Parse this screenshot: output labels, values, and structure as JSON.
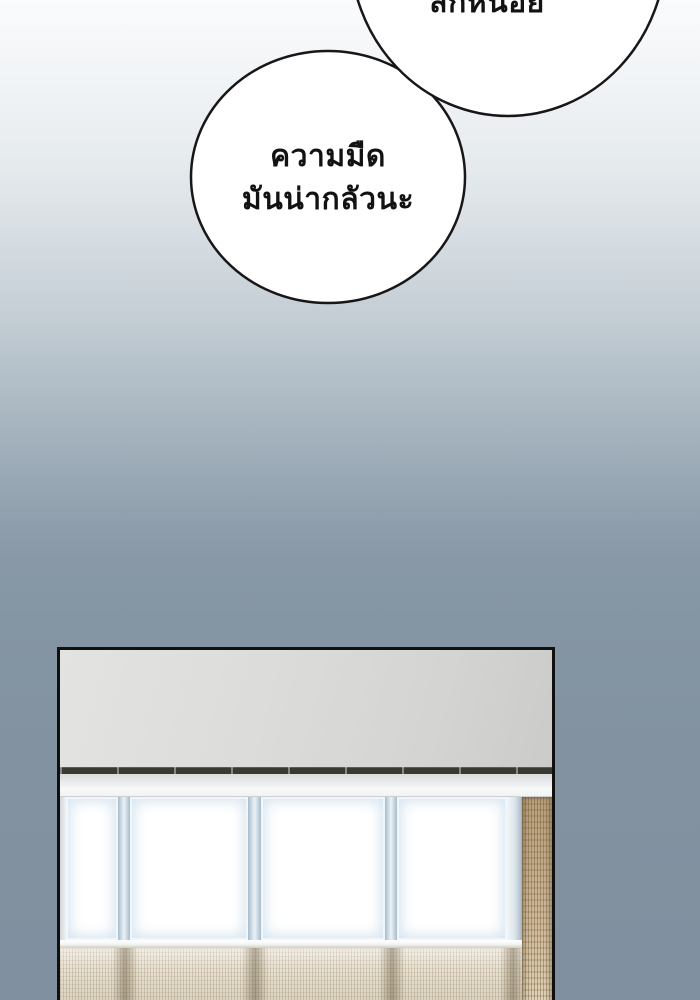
{
  "bubbles": {
    "top": {
      "text": "สักหน่อย"
    },
    "main": {
      "line1": "ความมืด",
      "line2": "มันน่ากลัวนะ"
    }
  },
  "colors": {
    "background_top": "#fafbfc",
    "background_bottom": "#8090a0",
    "bubble_fill": "#ffffff",
    "bubble_outline": "#17171a",
    "text": "#121212",
    "panel_border": "#101010",
    "ceiling_gray": "#d9d9d8",
    "window_glow_blue": "#d3e3ee",
    "curtain_tan": "#c9b28f",
    "curtain_light": "#e8e1d0"
  }
}
